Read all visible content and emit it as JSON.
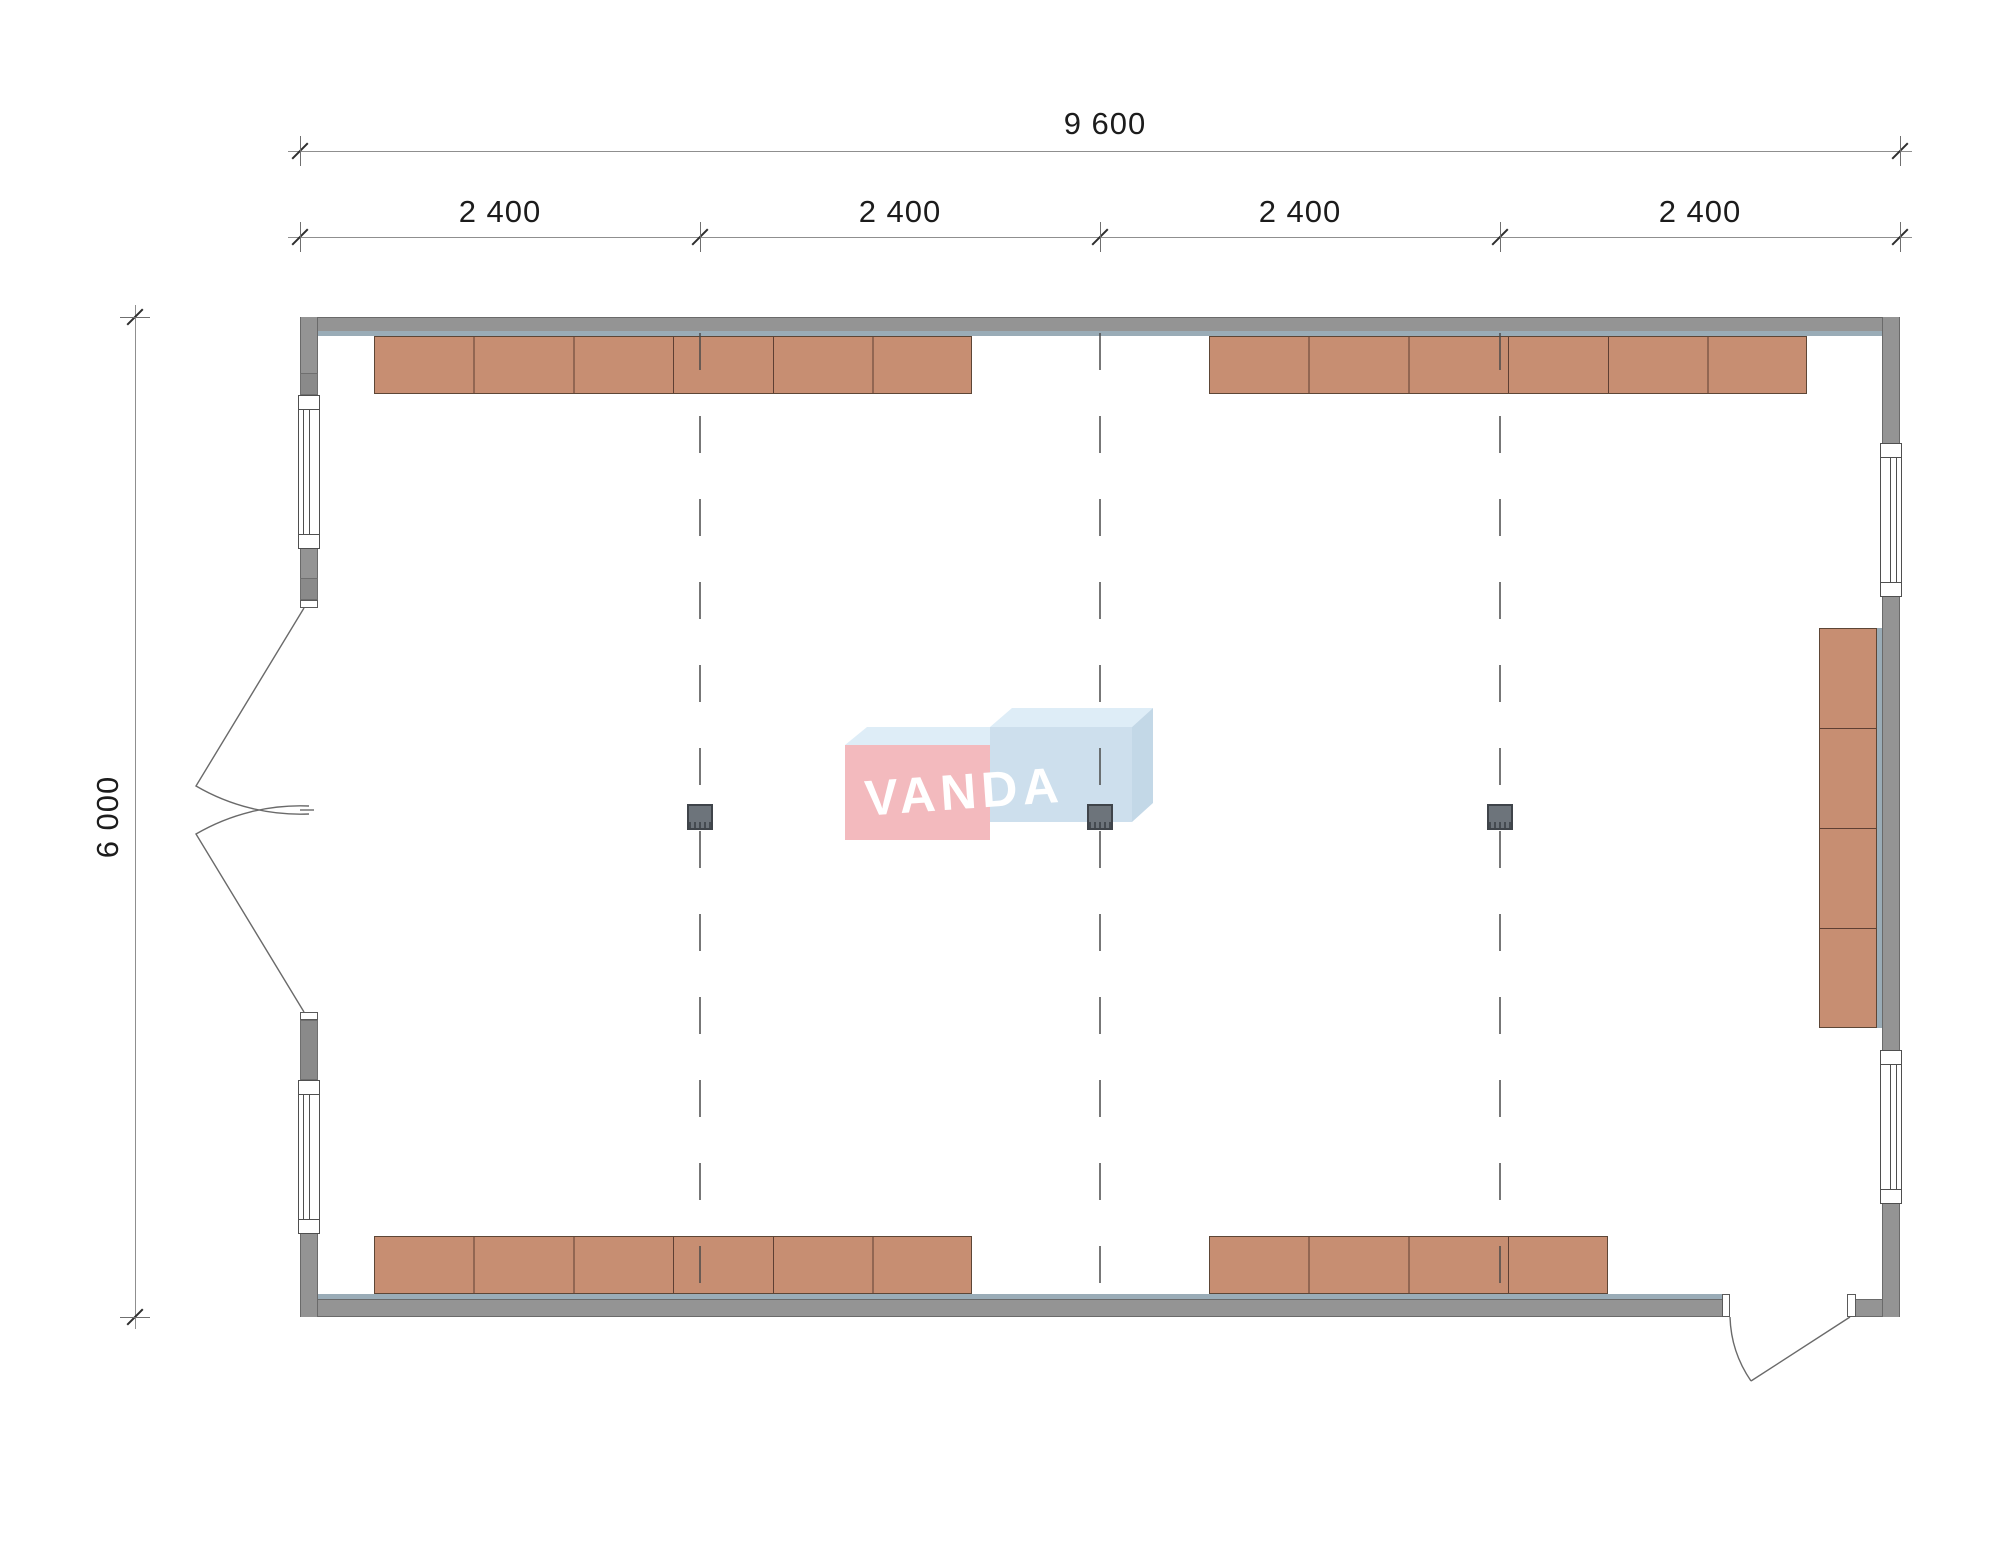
{
  "drawing": {
    "type": "floor-plan",
    "building_outline_mm": {
      "width": "9 600",
      "height": "6 000"
    }
  },
  "dimensions": {
    "total_width_label": "9 600",
    "bay_labels": [
      "2 400",
      "2 400",
      "2 400",
      "2 400"
    ],
    "height_label": "6 000"
  },
  "watermark": {
    "text": "VANDA",
    "pink": "#f2b5b9",
    "blue": "#c9ddec",
    "top_face": "#dcecf7",
    "side_face": "#bed5e6",
    "text_color": "#ffffff"
  },
  "plan": {
    "colors": {
      "wall_gray": "#949494",
      "wall_edge": "#6a6a6a",
      "interior_lining": "#9aacb7",
      "furniture_fill": "#c78e72",
      "furniture_line": "#5e3f33",
      "column_fill": "#6d747b",
      "grid_dash": "#4a4a4a",
      "dimension_text": "#1c1c1c"
    },
    "grid": {
      "bays": 4,
      "interior_grid_lines": 3
    },
    "columns_count": 3,
    "furniture_runs": {
      "top_left_units": 6,
      "top_right_units": 6,
      "bottom_left_units": 6,
      "bottom_right_units": 4,
      "right_wall_units": 4
    },
    "openings": {
      "left_wall": {
        "windows": 2,
        "doors": "double outswing"
      },
      "right_wall": {
        "windows": 2
      },
      "bottom_wall": {
        "doors": "single outswing"
      }
    }
  }
}
